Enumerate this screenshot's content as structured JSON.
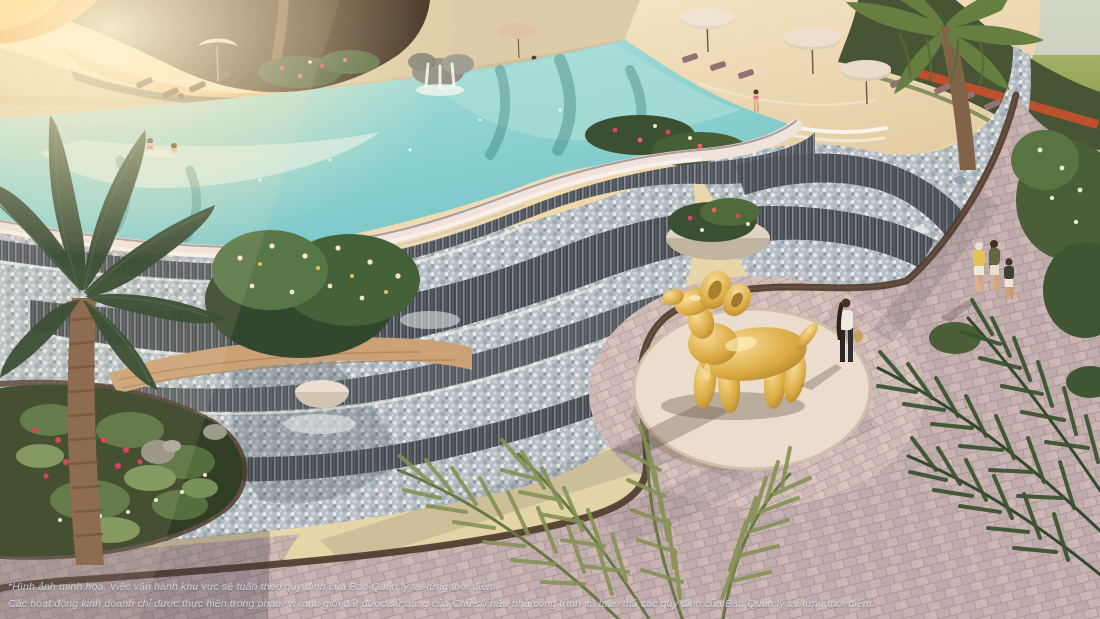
{
  "image": {
    "kind": "architectural-render",
    "subject": "Resort lagoon pool with cascading rock waterfall, pebble stream, curved paver promenade and golden balloon-dog sculpture"
  },
  "disclaimer": {
    "line1": "*Hình ảnh minh họa. Việc vận hành khu vực sẽ tuân theo quy định của Ban Quản lý tại từng thời điểm.",
    "line2": "Các hoạt động kinh doanh chỉ được thực hiện trong phạm vi ranh giới đất được sử dụng của Chủ sở hữu nhà/công trình và tuân thủ các quy định của Ban Quản lý tại từng thời điểm."
  },
  "palette": {
    "sun_glow": "#ffe9b8",
    "water_aqua": "#7fd0d4",
    "water_light": "#d8f2f0",
    "sand": "#ead9b6",
    "pebble": "#b3c0c9",
    "stone_dark": "#3c4651",
    "paver": "#bfadb2",
    "curb": "#453429",
    "plinth": "#e9e0d4",
    "sculpture_gold": "#d8a93f",
    "foliage_dark": "#24402a",
    "foliage_olive": "#7c8f52",
    "flower_red": "#cc2f42",
    "umbrella": "#e2d8c6",
    "roof": "#32241b",
    "lawn": "#9fae62"
  },
  "scene": {
    "elements": [
      "resort-building",
      "infinity-pool",
      "rock-waterfall",
      "sand-beach",
      "beach-umbrellas",
      "sun-loungers",
      "playground-slide",
      "cascade-terraces",
      "pebble-stream",
      "stone-curbs",
      "paver-walkway",
      "circular-plaza",
      "balloon-dog-sculpture",
      "flower-planters",
      "palm-trees",
      "swimmers",
      "beach-walkers",
      "plaza-visitor",
      "family-walking"
    ]
  }
}
